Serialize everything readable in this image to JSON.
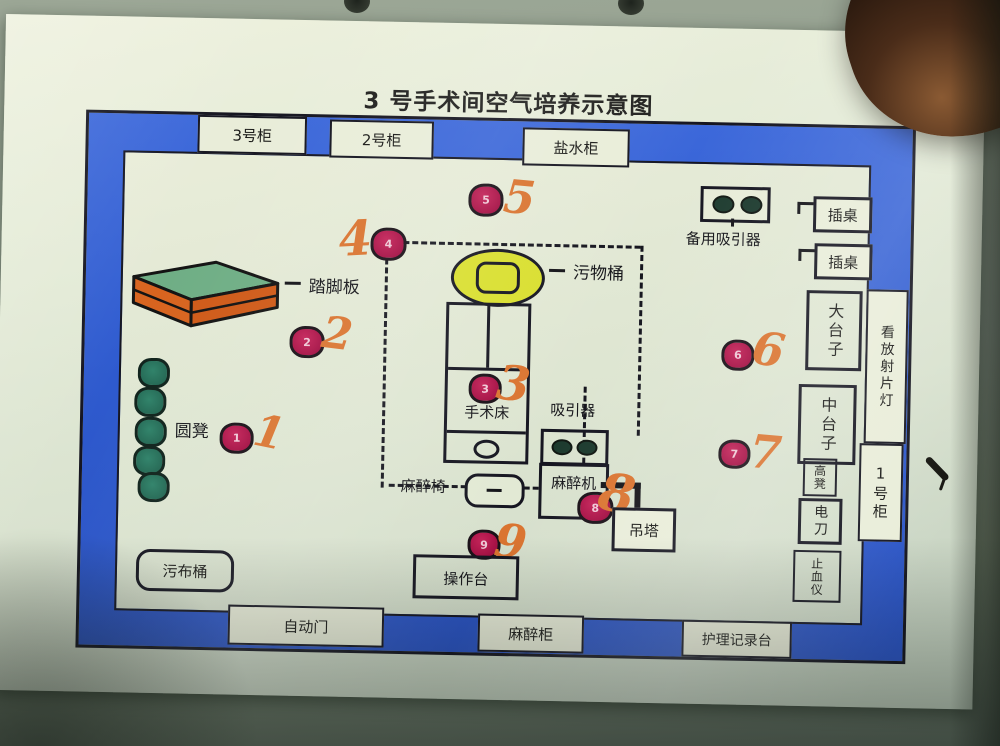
{
  "title": "3 号手术间空气培养示意图",
  "wall": {
    "cabinet3": "3号柜",
    "cabinet2": "2号柜",
    "saline_cabinet": "盐水柜",
    "auto_door": "自动门",
    "anesthesia_cabinet": "麻醉柜",
    "nursing_desk": "护理记录台",
    "xray_light": "看放射片灯",
    "cabinet1": "1号柜"
  },
  "labels": {
    "step_board": "踏脚板",
    "round_stool": "圆凳",
    "dirty_cloth_bucket": "污布桶",
    "waste_bucket": "污物桶",
    "operating_table": "手术床",
    "suction": "吸引器",
    "backup_suction": "备用吸引器",
    "anesthesia_chair": "麻醉椅",
    "anesthesia_machine": "麻醉机",
    "pendant_tower": "吊塔",
    "console": "操作台",
    "plug_table_a": "插桌",
    "plug_table_b": "插桌",
    "big_table": "大台子",
    "mid_table": "中台子",
    "high_stool": "高凳",
    "electro_knife": "电刀",
    "hemostasis_device": "止血仪"
  },
  "points": {
    "p1": {
      "dot": "1",
      "hand": "1"
    },
    "p2": {
      "dot": "2",
      "hand": "2"
    },
    "p3": {
      "dot": "3",
      "hand": "3"
    },
    "p4": {
      "dot": "4",
      "hand": "4"
    },
    "p5": {
      "dot": "5",
      "hand": "5"
    },
    "p6": {
      "dot": "6",
      "hand": "6"
    },
    "p7": {
      "dot": "7",
      "hand": "7"
    },
    "p8": {
      "dot": "8",
      "hand": "8"
    },
    "p9": {
      "dot": "9",
      "hand": "9"
    }
  },
  "colors": {
    "wall_blue": "#2e5ace",
    "dot_red": "#a60f44",
    "handwriting_orange": "#da7430",
    "stool_green": "#2a7a63",
    "waste_bucket_yellow": "#d9df2e",
    "step_board_orange": "#d8641f",
    "step_board_green": "#6fae85",
    "paper": "#dfe7d4"
  }
}
